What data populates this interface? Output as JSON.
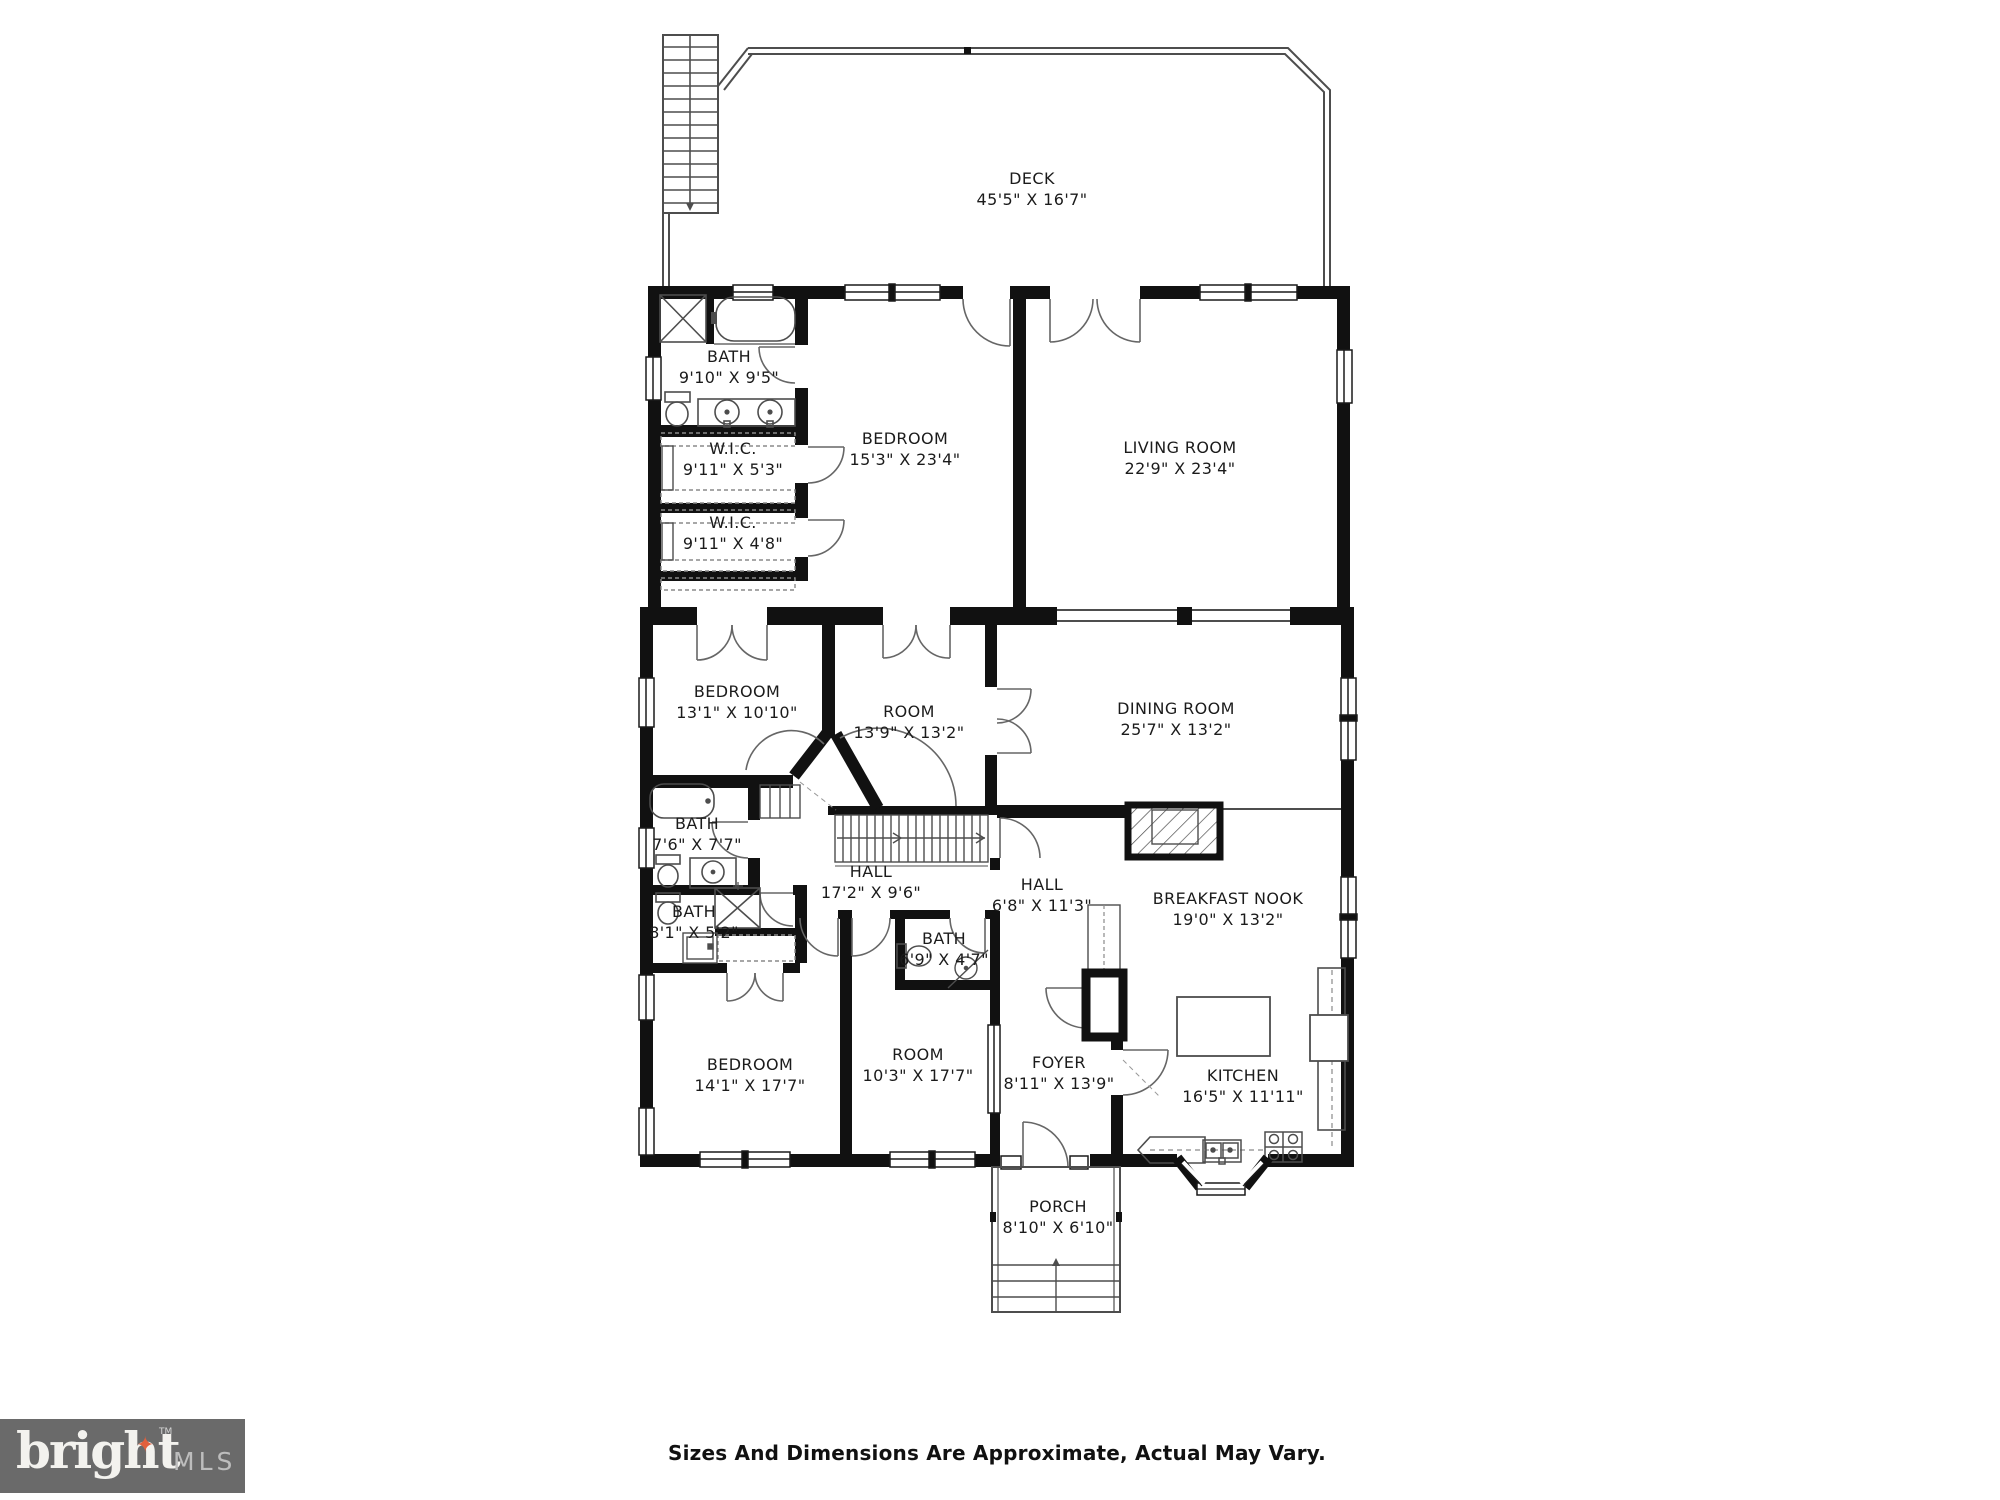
{
  "plan": {
    "rooms": [
      {
        "id": "deck",
        "name": "DECK",
        "dims": "45'5\" X 16'7\""
      },
      {
        "id": "bath-upper",
        "name": "BATH",
        "dims": "9'10\" X 9'5\""
      },
      {
        "id": "wic-1",
        "name": "W.I.C.",
        "dims": "9'11\" X 5'3\""
      },
      {
        "id": "wic-2",
        "name": "W.I.C.",
        "dims": "9'11\" X 4'8\""
      },
      {
        "id": "bedroom-upper",
        "name": "BEDROOM",
        "dims": "15'3\" X 23'4\""
      },
      {
        "id": "living-room",
        "name": "LIVING ROOM",
        "dims": "22'9\" X 23'4\""
      },
      {
        "id": "bedroom-mid",
        "name": "BEDROOM",
        "dims": "13'1\" X 10'10\""
      },
      {
        "id": "room-mid",
        "name": "ROOM",
        "dims": "13'9\" X 13'2\""
      },
      {
        "id": "dining-room",
        "name": "DINING ROOM",
        "dims": "25'7\" X 13'2\""
      },
      {
        "id": "bath-mid",
        "name": "BATH",
        "dims": "7'6\" X 7'7\""
      },
      {
        "id": "hall-west",
        "name": "HALL",
        "dims": "17'2\" X 9'6\""
      },
      {
        "id": "hall-east",
        "name": "HALL",
        "dims": "6'8\" X 11'3\""
      },
      {
        "id": "breakfast-nook",
        "name": "BREAKFAST NOOK",
        "dims": "19'0\" X 13'2\""
      },
      {
        "id": "bath-small",
        "name": "BATH",
        "dims": "8'1\" X 5'2\""
      },
      {
        "id": "bath-center",
        "name": "BATH",
        "dims": "6'9\" X 4'7\""
      },
      {
        "id": "bedroom-lower",
        "name": "BEDROOM",
        "dims": "14'1\" X 17'7\""
      },
      {
        "id": "room-lower",
        "name": "ROOM",
        "dims": "10'3\" X 17'7\""
      },
      {
        "id": "foyer",
        "name": "FOYER",
        "dims": "8'11\" X 13'9\""
      },
      {
        "id": "kitchen",
        "name": "KITCHEN",
        "dims": "16'5\" X 11'11\""
      },
      {
        "id": "porch",
        "name": "PORCH",
        "dims": "8'10\" X 6'10\""
      }
    ]
  },
  "footer": {
    "disclaimer": "Sizes And Dimensions Are Approximate, Actual May Vary."
  },
  "logo": {
    "brand": "bright",
    "star": "✦",
    "tm": "TM",
    "suffix": "MLS"
  },
  "colors": {
    "wall": "#111111",
    "thin_line": "#4d4d4d",
    "logo_bg": "#6a6a6a",
    "logo_star": "#e2603c"
  }
}
